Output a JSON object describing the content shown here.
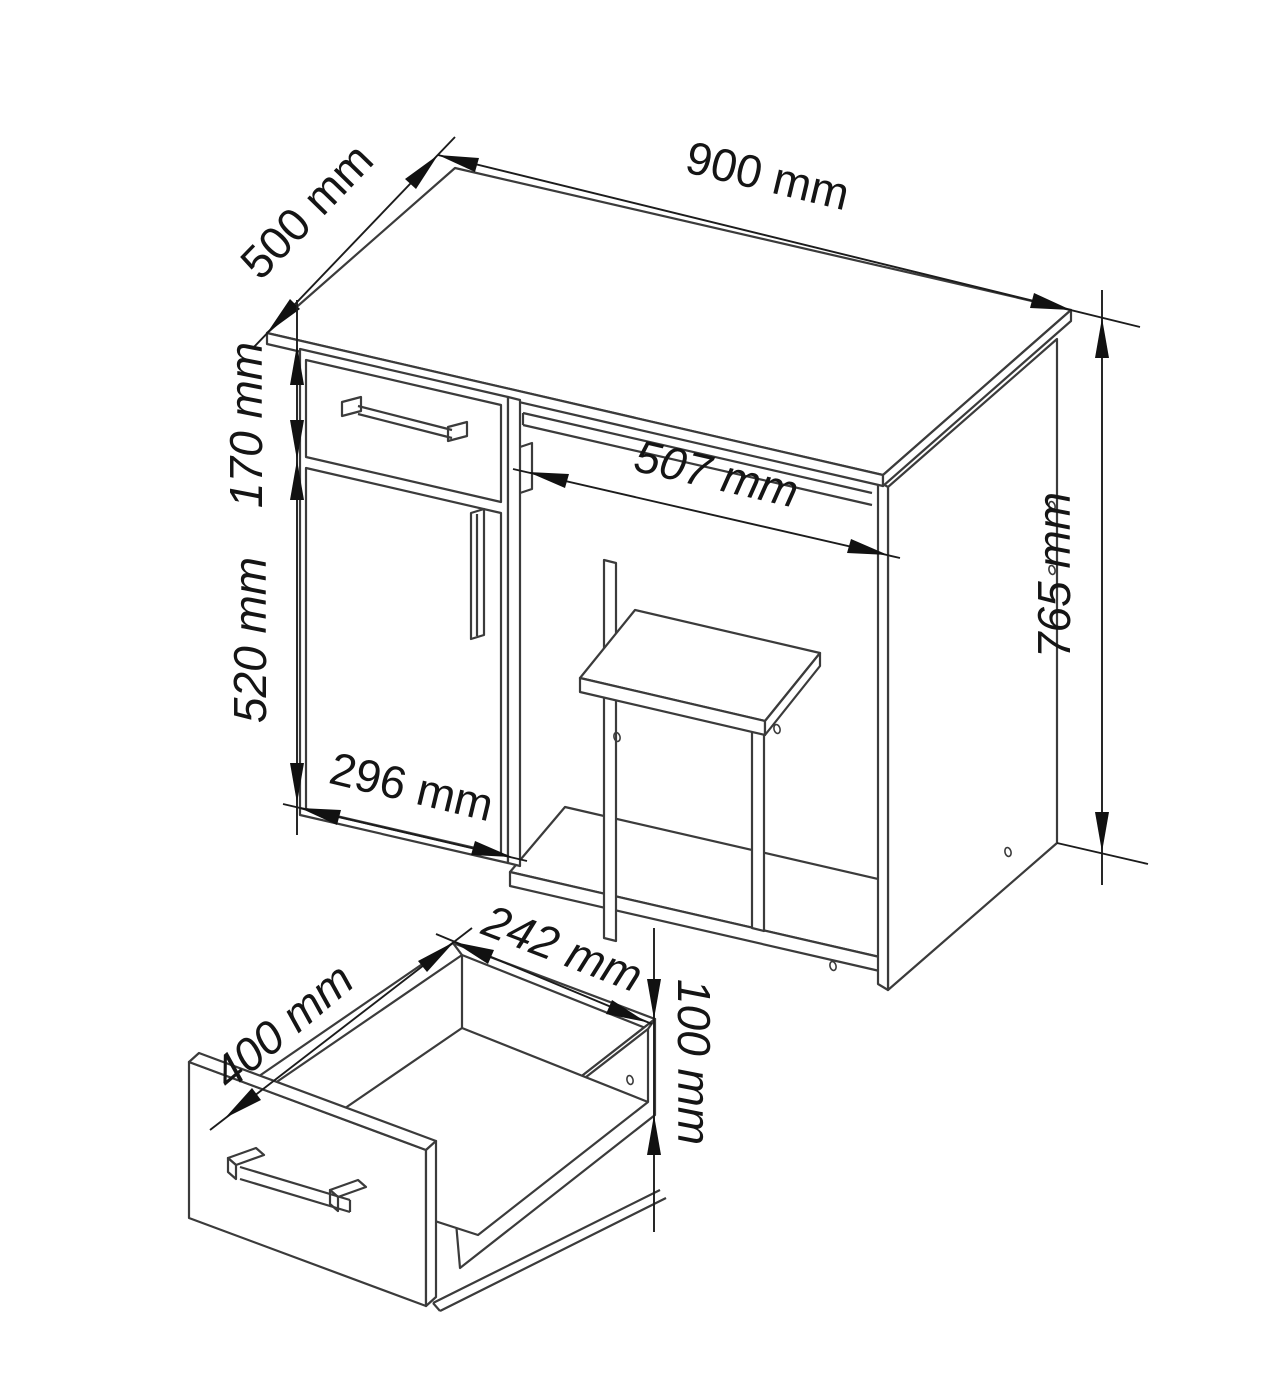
{
  "figure": {
    "type": "furniture technical drawing",
    "subject": "computer desk with drawer, door cabinet, keyboard tray and separate pulled-out drawer box",
    "background_color": "#ffffff",
    "line_color": "#3b3b3b",
    "text_color": "#151515"
  },
  "dimensions": {
    "desk_width": "900 mm",
    "desk_depth": "500 mm",
    "drawer_front_height": "170 mm",
    "door_height": "520 mm",
    "cabinet_width": "296 mm",
    "keyboard_tray_width": "507 mm",
    "desk_height": "765 mm",
    "drawer_depth": "400 mm",
    "drawer_inner_width": "242 mm",
    "drawer_side_height": "100 mm"
  }
}
